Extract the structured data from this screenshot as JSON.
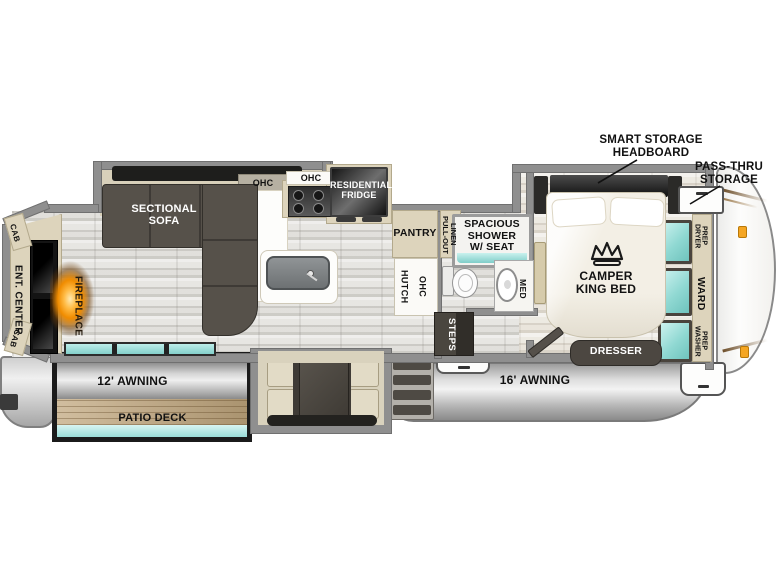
{
  "fp": {
    "rear": {
      "cab_top": "CAB",
      "ent_center": "ENT. CENTER",
      "fireplace": "FIREPLACE",
      "cab_bottom": "CAB",
      "sectional_sofa": "SECTIONAL SOFA"
    },
    "kitchen": {
      "ohc_shelf": "OHC",
      "ohc_range": "OHC",
      "residential_fridge": "RESIDENTIAL FRIDGE",
      "pantry": "PANTRY",
      "pull_out_linen": "PULL-OUT LINEN",
      "hutch": "HUTCH",
      "hutch_ohc": "OHC"
    },
    "bath": {
      "shower": "SPACIOUS SHOWER W/ SEAT",
      "med": "MED",
      "steps": "STEPS"
    },
    "bedroom": {
      "smart_storage_headboard": "SMART STORAGE HEADBOARD",
      "pass_thru_storage": "PASS-THRU STORAGE",
      "camper_king_bed": "CAMPER KING BED",
      "dresser": "DRESSER",
      "dryer_prep": "DRYER PREP",
      "ward": "WARD",
      "washer_prep": "WASHER PREP"
    },
    "exterior": {
      "awning_16": "16' AWNING",
      "awning_12": "12' AWNING",
      "patio_deck": "PATIO DECK"
    }
  },
  "colors": {
    "wall": "#8f8f8f",
    "cream": "#ddd4bc",
    "dark_furniture": "#4d4841",
    "teal_glass": "#93dbd6",
    "fireplace_glow": "#f59300",
    "deck_wood": "#c2a87f",
    "label_ink": "#111111"
  }
}
